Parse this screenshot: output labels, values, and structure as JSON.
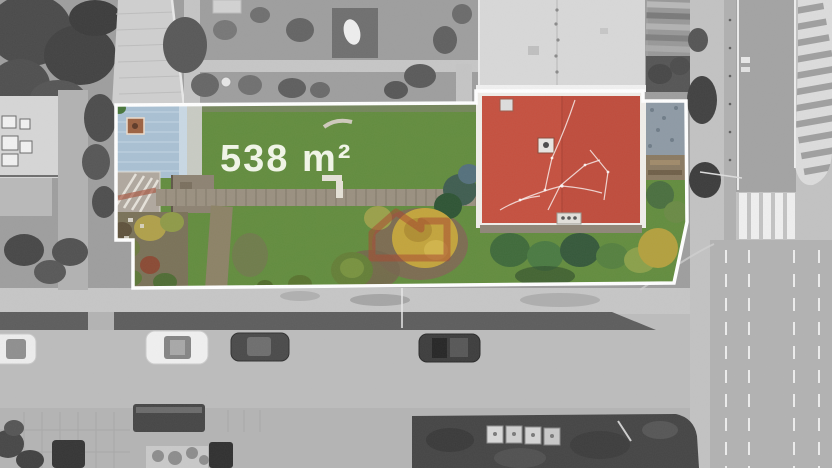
{
  "property_overlay": {
    "area_label": "538 m²",
    "boundary_color": "#ffffff",
    "label_color": "#f2f6e8"
  },
  "watermark": {
    "icon": "house-outline-watermark-icon",
    "color": "#a8492f",
    "opacity": "0.55"
  },
  "scene": {
    "type": "aerial-drone-photo",
    "description": "Real-estate listing photo: building plot highlighted in color with white boundary over desaturated surroundings",
    "palette": {
      "lawn_green": "#5f8c3c",
      "red_roof": "#c5503f",
      "blue_roof": "#a9c0d3",
      "autumn_tree_yellow": "#c3a43c",
      "grayscale_road": "#bcbcbc",
      "hedge_dark": "#454545"
    }
  }
}
